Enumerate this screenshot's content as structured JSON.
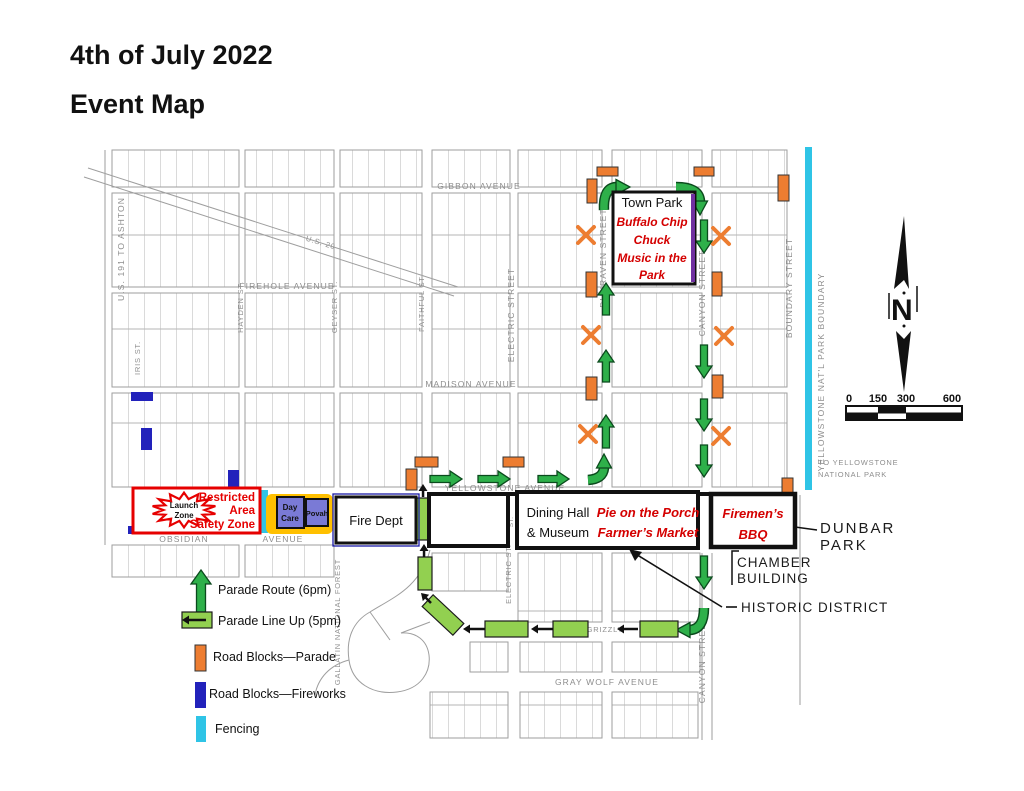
{
  "title": {
    "line1": "4th of July 2022",
    "line2": "Event Map"
  },
  "legend": {
    "parade_route": "Parade Route (6pm)",
    "parade_lineup": "Parade Line Up (5pm)",
    "roadblocks_parade": "Road Blocks—Parade",
    "roadblocks_fireworks": "Road Blocks—Fireworks",
    "fencing": "Fencing"
  },
  "landmarks": {
    "town_park_title": "Town Park",
    "town_park_l1": "Buffalo Chip",
    "town_park_l2": "Chuck",
    "town_park_l3": "Music in the",
    "town_park_l4": "Park",
    "launch_l1": "Launch",
    "launch_l2": "Zone",
    "restricted_l1": "Restricted",
    "restricted_l2": "Area",
    "restricted_l3": "Safety Zone",
    "daycare_l1": "Day",
    "daycare_l2": "Care",
    "povah": "Povah",
    "fire_dept": "Fire Dept",
    "dining_l1": "Dining Hall",
    "dining_l2": "& Museum",
    "pie_l1": "Pie on the Porch",
    "pie_l2": "Farmer’s Market",
    "bbq_l1": "Firemen’s",
    "bbq_l2": "BBQ",
    "dunbar_l1": "DUNBAR",
    "dunbar_l2": "PARK",
    "chamber_l1": "CHAMBER",
    "chamber_l2": "BUILDING",
    "historic": "HISTORIC DISTRICT"
  },
  "streets": {
    "gibbon": "GIBBON AVENUE",
    "firehole": "FIREHOLE AVENUE",
    "madison": "MADISON AVENUE",
    "yellowstone": "YELLOWSTONE AVENUE",
    "obsidian": "OBSIDIAN",
    "avenue": "AVENUE",
    "grizzly": "GRIZZLY",
    "gray_wolf": "GRAY WOLF AVENUE",
    "us191": "U.S. 191 TO ASHTON",
    "us20": "U.S. 20",
    "iris": "IRIS ST.",
    "hayden": "HAYDEN ST.",
    "geyser": "GEYSER ST.",
    "faithful": "FAITHFUL ST.",
    "electric": "ELECTRIC STREET",
    "electric_lower": "ELECTRIC ST.",
    "electric_gap": "ST.",
    "dunraven": "DUNRAVEN STREET",
    "canyon": "CANYON STREET",
    "canyon_lower": "CANYON STREET",
    "boundary": "BOUNDARY STREET",
    "park_boundary": "YELLOWSTONE NAT'L PARK BOUNDARY",
    "gallatin": "GALLATIN NATIONAL FOREST",
    "to_park_l1": "TO YELLOWSTONE",
    "to_park_l2": "NATIONAL PARK"
  },
  "compass": {
    "n": "N"
  },
  "scalebar": {
    "t0": "0",
    "t1": "150",
    "t2": "300",
    "t3": "600"
  },
  "colors": {
    "route_green": "#2eb04a",
    "route_green_dark": "#0b4a1d",
    "lineup_green": "#92d050",
    "roadblock_orange": "#ed7d31",
    "roadblock_blue": "#2222bb",
    "fencing_cyan": "#2fc4e6",
    "restricted_red": "#e60000",
    "event_red": "#d40000",
    "daycare_purple": "#7a7ad6",
    "daycare_yellow": "#ffc000",
    "townpark_purple": "#7030a0"
  }
}
